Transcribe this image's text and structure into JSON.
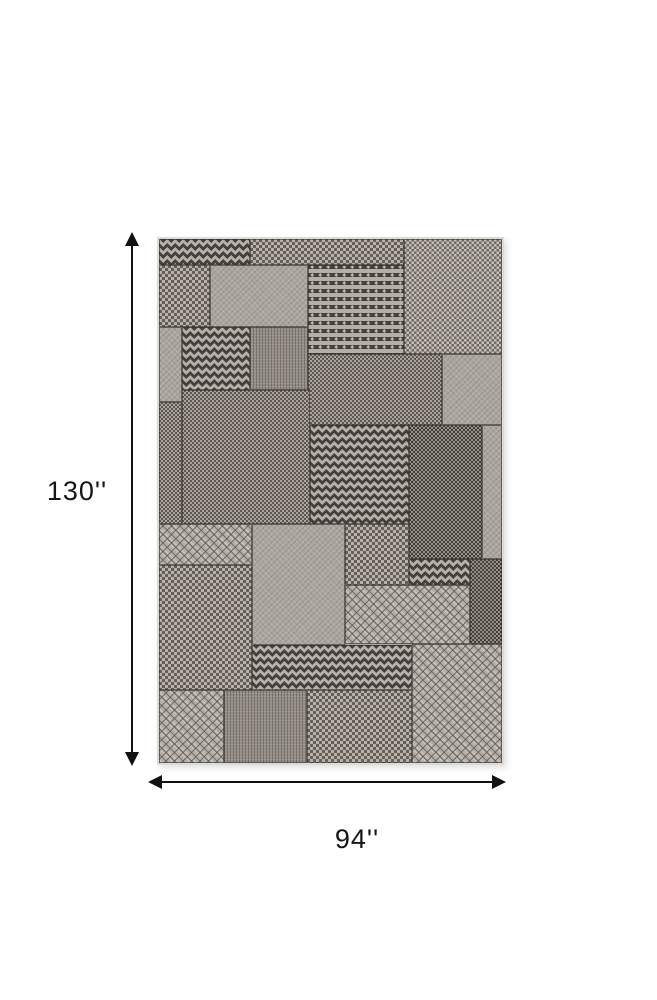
{
  "image_type": "product dimension illustration of a gray geometric patchwork outdoor rug",
  "dimensions": {
    "height_label": "130''",
    "width_label": "94''"
  },
  "colors": {
    "bg": "#ffffff",
    "arrow": "#111111",
    "seam": "rgba(52,48,44,0.6)",
    "chev-dark": "#44403b",
    "chev-light": "#b5b0a9",
    "basket-dk-a": "#6f6962",
    "basket-lt-a": "#c4bfb8",
    "basket-dk-b": "#5d5750",
    "basket-lt-b": "#aaa49d",
    "basket-dk-c": "#453f3a",
    "basket-lt-c": "#958f88",
    "basket-dk-d": "#665f58",
    "basket-lt-d": "#b7b1aa",
    "plain": "#aba59e",
    "plain-dark": "#948d86",
    "diamond-base": "#b4afa8"
  },
  "rug": {
    "position": {
      "left": 157,
      "top": 237,
      "width": 343,
      "height": 524
    },
    "patches": [
      {
        "x": 0,
        "y": 0,
        "w": 91,
        "h": 26,
        "texture": "chevron-h"
      },
      {
        "x": 91,
        "y": 0,
        "w": 154,
        "h": 26,
        "texture": "basket-coarse"
      },
      {
        "x": 245,
        "y": 0,
        "w": 98,
        "h": 115,
        "texture": "basket-light"
      },
      {
        "x": 0,
        "y": 26,
        "w": 51,
        "h": 62,
        "texture": "basket-coarse"
      },
      {
        "x": 51,
        "y": 26,
        "w": 98,
        "h": 62,
        "texture": "plain"
      },
      {
        "x": 149,
        "y": 26,
        "w": 96,
        "h": 89,
        "texture": "chevron-v"
      },
      {
        "x": 0,
        "y": 88,
        "w": 23,
        "h": 75,
        "texture": "plain"
      },
      {
        "x": 0,
        "y": 163,
        "w": 23,
        "h": 122,
        "texture": "basket-mid"
      },
      {
        "x": 23,
        "y": 88,
        "w": 68,
        "h": 63,
        "texture": "chevron-h"
      },
      {
        "x": 91,
        "y": 88,
        "w": 58,
        "h": 63,
        "texture": "plain-dark"
      },
      {
        "x": 149,
        "y": 115,
        "w": 134,
        "h": 71,
        "texture": "basket-mid"
      },
      {
        "x": 283,
        "y": 115,
        "w": 60,
        "h": 71,
        "texture": "plain"
      },
      {
        "x": 23,
        "y": 151,
        "w": 128,
        "h": 134,
        "texture": "basket-mid"
      },
      {
        "x": 151,
        "y": 186,
        "w": 99,
        "h": 99,
        "texture": "chevron-h"
      },
      {
        "x": 250,
        "y": 186,
        "w": 73,
        "h": 134,
        "texture": "basket-dark"
      },
      {
        "x": 323,
        "y": 186,
        "w": 20,
        "h": 134,
        "texture": "plain"
      },
      {
        "x": 0,
        "y": 285,
        "w": 93,
        "h": 41,
        "texture": "diamond"
      },
      {
        "x": 0,
        "y": 326,
        "w": 93,
        "h": 125,
        "texture": "basket-coarse"
      },
      {
        "x": 93,
        "y": 285,
        "w": 93,
        "h": 121,
        "texture": "plain"
      },
      {
        "x": 186,
        "y": 285,
        "w": 64,
        "h": 61,
        "texture": "basket-coarse"
      },
      {
        "x": 250,
        "y": 320,
        "w": 61,
        "h": 26,
        "texture": "chevron-h"
      },
      {
        "x": 186,
        "y": 346,
        "w": 125,
        "h": 59,
        "texture": "diamond"
      },
      {
        "x": 311,
        "y": 320,
        "w": 32,
        "h": 85,
        "texture": "basket-dark"
      },
      {
        "x": 93,
        "y": 406,
        "w": 160,
        "h": 45,
        "texture": "chevron-h"
      },
      {
        "x": 253,
        "y": 405,
        "w": 90,
        "h": 119,
        "texture": "diamond"
      },
      {
        "x": 0,
        "y": 451,
        "w": 65,
        "h": 73,
        "texture": "diamond"
      },
      {
        "x": 65,
        "y": 451,
        "w": 83,
        "h": 73,
        "texture": "plain-dark"
      },
      {
        "x": 148,
        "y": 451,
        "w": 105,
        "h": 73,
        "texture": "basket-coarse"
      }
    ]
  }
}
